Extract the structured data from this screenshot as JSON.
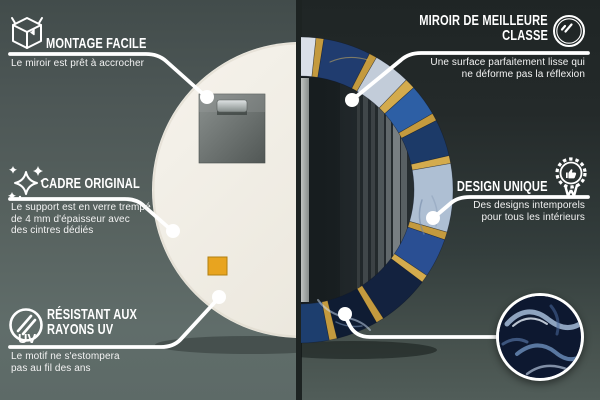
{
  "callouts": {
    "montage_facile": {
      "icon": "package-box-icon",
      "title": "MONTAGE FACILE",
      "subtitle": "Le miroir est prêt à accrocher"
    },
    "cadre_original": {
      "icon": "sparkles-icon",
      "title": "CADRE ORIGINAL",
      "subtitle_lines": [
        "Le support est en verre trempé",
        "de 4 mm d'épaisseur avec",
        "des cintres dédiés"
      ]
    },
    "resistant_uv": {
      "icon": "uv-protection-icon",
      "icon_label": "UV",
      "title_lines": [
        "RÉSISTANT AUX",
        "RAYONS UV"
      ],
      "subtitle_lines": [
        "Le motif ne s'estompera",
        "pas au fil des ans"
      ]
    },
    "miroir_classe": {
      "icon": "mirror-shine-icon",
      "title_lines": [
        "MIROIR DE MEILLEURE",
        "CLASSE"
      ],
      "subtitle_lines": [
        "Une surface parfaitement lisse qui",
        "ne déforme pas la réflexion"
      ]
    },
    "design_unique": {
      "icon": "award-badge-icon",
      "title": "DESIGN UNIQUE",
      "subtitle_lines": [
        "Des designs intemporels",
        "pour tous les intérieurs"
      ]
    }
  },
  "scene": {
    "left_view": "mirror-back-with-hanger-plate",
    "right_view": "mirror-front-with-blue-marble-frame",
    "detail_inset": "blue-marble-texture-closeup"
  },
  "colors": {
    "wallLeftTop": "#424c4b",
    "wallLeftBottom": "#5d6a67",
    "wallRightTop": "#1f2525",
    "wallRightBottom": "#515d59",
    "divider": "#1d2322",
    "calloutLine": "#ffffff",
    "textPrimary": "#ffffff",
    "mirrorBack": "#f2efe8",
    "hangerPlate": "#6e7472",
    "adhesivePad": "#e8a41f",
    "frameGold": "#c49a3e",
    "frameNavy": "#13223f",
    "frameBlue": "#2d5fa5",
    "frameMarble": "#c2ccd9",
    "mirrorFace": "#171d20",
    "detailNavy": "#0d1830"
  },
  "mirror": {
    "frame_segments": [
      {
        "from": 0,
        "to": 6,
        "color": "#d9dfe8"
      },
      {
        "from": 6,
        "to": 9,
        "color": "#c49a3e"
      },
      {
        "from": 9,
        "to": 27,
        "color": "#203c6f"
      },
      {
        "from": 27,
        "to": 30,
        "color": "#c49a3e"
      },
      {
        "from": 30,
        "to": 44,
        "color": "#c2ccd9"
      },
      {
        "from": 44,
        "to": 48,
        "color": "#d4ab4d"
      },
      {
        "from": 48,
        "to": 60,
        "color": "#2d5fa5"
      },
      {
        "from": 60,
        "to": 63,
        "color": "#c49a3e"
      },
      {
        "from": 63,
        "to": 77,
        "color": "#1c3a68"
      },
      {
        "from": 77,
        "to": 80,
        "color": "#d4ab4d"
      },
      {
        "from": 80,
        "to": 106,
        "color": "#aebfd3"
      },
      {
        "from": 106,
        "to": 109,
        "color": "#c49a3e"
      },
      {
        "from": 109,
        "to": 124,
        "color": "#2a4f93"
      },
      {
        "from": 124,
        "to": 127,
        "color": "#d4ab4d"
      },
      {
        "from": 127,
        "to": 147,
        "color": "#13223f"
      },
      {
        "from": 147,
        "to": 150,
        "color": "#c49a3e"
      },
      {
        "from": 150,
        "to": 166,
        "color": "#0f1c33"
      },
      {
        "from": 166,
        "to": 169,
        "color": "#c49a3e"
      },
      {
        "from": 169,
        "to": 180,
        "color": "#1d3e6e"
      }
    ]
  }
}
